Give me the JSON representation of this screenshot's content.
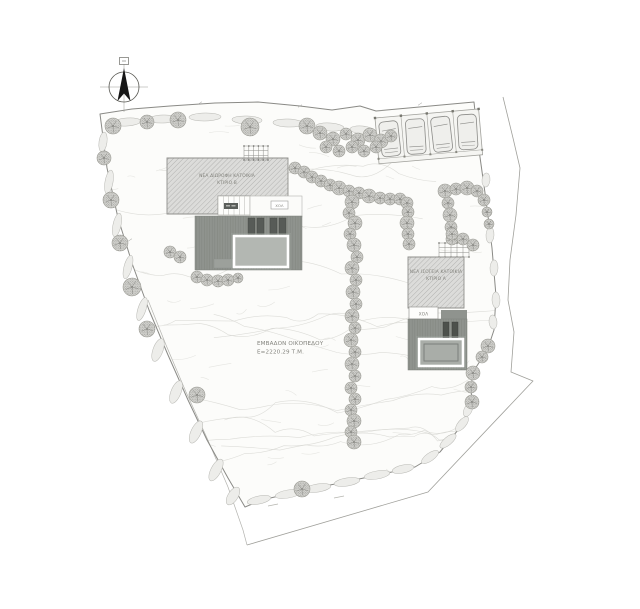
{
  "page": {
    "width": 640,
    "height": 609,
    "background": "#ffffff"
  },
  "labels": {
    "building_b_line1": "ΝΕΑ ΔΙΩΡΟΦΗ ΚΑΤΟΙΚΙΑ",
    "building_b_line2": "ΚΤΙΡΙΟ Β",
    "building_a_line1": "ΝΕΑ ΙΣΟΓΕΙΑ ΚΑΤΟΙΚΙΑ",
    "building_a_line2": "ΚΤΙΡΙΟ Α",
    "hall_b": "ΧΟΛ",
    "hall_a": "ΧΟΛ",
    "area_line1": "ΕΜΒΑΔΟΝ ΟΙΚΟΠΕΔΟΥ",
    "area_line2": "Ε=2220.29 Τ.Μ."
  },
  "colors": {
    "plot_fill": "#fcfcfa",
    "boundary": "#8a8a86",
    "road": "#a0a09b",
    "hatch_bg": "#dcdcda",
    "hatch_line": "#b2b2b0",
    "hatch_edge": "#8f8f8c",
    "terrace": "#8f938e",
    "terrace_edge": "#7c807b",
    "pool_b": "#b3b7b2",
    "pool_a": "#a9ada8",
    "pool_edge": "#7c807b",
    "lounger": "#575b57",
    "door": "#4d514c",
    "tree_fill": "#d2d2ce",
    "tree_dot": "#8e8e8a",
    "tree_edge": "#96968f",
    "shrub": "#b7b7b2",
    "shrub_fill": "#ededea",
    "texture": "#e5e5e1",
    "texture2": "#d7d7d2",
    "car": "#efefec",
    "car_edge": "#8b8b88",
    "label": "#84847e",
    "north": "#161616"
  },
  "drawing": {
    "boundary": [
      [
        100,
        114
      ],
      [
        132,
        109
      ],
      [
        170,
        106
      ],
      [
        215,
        103
      ],
      [
        258,
        102
      ],
      [
        300,
        106
      ],
      [
        332,
        110
      ],
      [
        360,
        106
      ],
      [
        376,
        111
      ],
      [
        474,
        102
      ],
      [
        479,
        150
      ],
      [
        486,
        200
      ],
      [
        492,
        248
      ],
      [
        496,
        296
      ],
      [
        494,
        330
      ],
      [
        489,
        345
      ],
      [
        482,
        358
      ],
      [
        473,
        372
      ],
      [
        471,
        388
      ],
      [
        472,
        404
      ],
      [
        458,
        430
      ],
      [
        440,
        452
      ],
      [
        415,
        467
      ],
      [
        378,
        475
      ],
      [
        340,
        483
      ],
      [
        300,
        491
      ],
      [
        262,
        500
      ],
      [
        245,
        507
      ],
      [
        228,
        478
      ],
      [
        207,
        440
      ],
      [
        188,
        400
      ],
      [
        168,
        355
      ],
      [
        149,
        310
      ],
      [
        133,
        266
      ],
      [
        118,
        218
      ],
      [
        107,
        168
      ]
    ],
    "outer_road_right": [
      [
        503,
        97
      ],
      [
        513,
        138
      ],
      [
        520,
        168
      ],
      [
        516,
        215
      ],
      [
        510,
        260
      ],
      [
        508,
        300
      ],
      [
        514,
        332
      ],
      [
        511,
        372
      ],
      [
        533,
        381
      ],
      [
        428,
        492
      ],
      [
        247,
        545
      ]
    ],
    "outer_road_left": [
      [
        148,
        300
      ],
      [
        166,
        345
      ],
      [
        186,
        392
      ],
      [
        207,
        438
      ],
      [
        228,
        487
      ],
      [
        243,
        530
      ],
      [
        247,
        545
      ]
    ],
    "road_dashes": [
      [
        268,
        506,
        278,
        504
      ],
      [
        334,
        498,
        344,
        496
      ]
    ],
    "ticks": [
      [
        200,
        103
      ],
      [
        300,
        106
      ],
      [
        420,
        104
      ],
      [
        487,
        220
      ],
      [
        495,
        300
      ],
      [
        310,
        489
      ],
      [
        130,
        240
      ]
    ],
    "trees": [
      [
        113,
        126,
        8
      ],
      [
        147,
        122,
        7
      ],
      [
        178,
        120,
        8
      ],
      [
        250,
        127,
        9
      ],
      [
        307,
        126,
        8
      ],
      [
        320,
        133,
        7
      ],
      [
        333,
        139,
        7
      ],
      [
        346,
        134,
        6
      ],
      [
        358,
        140,
        7
      ],
      [
        370,
        135,
        7
      ],
      [
        381,
        141,
        7
      ],
      [
        391,
        136,
        6
      ],
      [
        326,
        147,
        6
      ],
      [
        339,
        151,
        6
      ],
      [
        352,
        147,
        6
      ],
      [
        364,
        151,
        6
      ],
      [
        376,
        147,
        6
      ],
      [
        104,
        158,
        7
      ],
      [
        111,
        200,
        8
      ],
      [
        120,
        243,
        8
      ],
      [
        132,
        287,
        9
      ],
      [
        147,
        329,
        8
      ],
      [
        197,
        395,
        8
      ],
      [
        302,
        489,
        8
      ],
      [
        488,
        346,
        7
      ],
      [
        482,
        357,
        6
      ],
      [
        473,
        373,
        7
      ],
      [
        471,
        387,
        6
      ],
      [
        472,
        402,
        7
      ],
      [
        445,
        191,
        7
      ],
      [
        456,
        189,
        6
      ],
      [
        467,
        188,
        7
      ],
      [
        477,
        191,
        6
      ],
      [
        484,
        200,
        6
      ],
      [
        448,
        203,
        6
      ],
      [
        450,
        215,
        7
      ],
      [
        451,
        227,
        6
      ],
      [
        452,
        239,
        6
      ],
      [
        487,
        212,
        5
      ],
      [
        489,
        224,
        5
      ],
      [
        452,
        234,
        6
      ],
      [
        463,
        239,
        6
      ],
      [
        473,
        245,
        6
      ],
      [
        295,
        168,
        6
      ],
      [
        304,
        172,
        6
      ],
      [
        312,
        177,
        6
      ],
      [
        321,
        181,
        6
      ],
      [
        330,
        185,
        6
      ],
      [
        339,
        188,
        7
      ],
      [
        349,
        191,
        6
      ],
      [
        359,
        193,
        6
      ],
      [
        369,
        196,
        7
      ],
      [
        380,
        198,
        6
      ],
      [
        390,
        199,
        6
      ],
      [
        400,
        199,
        6
      ],
      [
        407,
        203,
        6
      ],
      [
        408,
        212,
        6
      ],
      [
        407,
        223,
        7
      ],
      [
        408,
        234,
        6
      ],
      [
        409,
        244,
        6
      ],
      [
        352,
        202,
        7
      ],
      [
        349,
        213,
        6
      ],
      [
        355,
        223,
        7
      ],
      [
        350,
        234,
        6
      ],
      [
        354,
        245,
        7
      ],
      [
        357,
        257,
        6
      ],
      [
        352,
        268,
        7
      ],
      [
        356,
        280,
        6
      ],
      [
        353,
        292,
        7
      ],
      [
        356,
        304,
        6
      ],
      [
        352,
        316,
        7
      ],
      [
        355,
        328,
        6
      ],
      [
        351,
        340,
        7
      ],
      [
        355,
        352,
        6
      ],
      [
        352,
        364,
        7
      ],
      [
        355,
        376,
        6
      ],
      [
        351,
        388,
        6
      ],
      [
        355,
        399,
        6
      ],
      [
        351,
        410,
        6
      ],
      [
        354,
        421,
        7
      ],
      [
        351,
        432,
        6
      ],
      [
        354,
        442,
        7
      ],
      [
        170,
        252,
        6
      ],
      [
        180,
        257,
        6
      ],
      [
        197,
        277,
        6
      ],
      [
        207,
        280,
        6
      ],
      [
        218,
        281,
        6
      ],
      [
        228,
        280,
        6
      ],
      [
        238,
        278,
        5
      ]
    ],
    "shrubs": [
      [
        127,
        122,
        14,
        4,
        -4
      ],
      [
        163,
        119,
        15,
        4,
        -2
      ],
      [
        205,
        117,
        16,
        4,
        -1
      ],
      [
        247,
        120,
        15,
        4,
        2
      ],
      [
        288,
        123,
        15,
        4,
        2
      ],
      [
        330,
        127,
        14,
        4,
        4
      ],
      [
        362,
        130,
        12,
        4,
        5
      ],
      [
        103,
        142,
        4,
        10,
        8
      ],
      [
        109,
        182,
        4,
        12,
        10
      ],
      [
        117,
        225,
        4,
        12,
        12
      ],
      [
        128,
        267,
        4,
        12,
        15
      ],
      [
        142,
        309,
        4,
        12,
        18
      ],
      [
        158,
        350,
        5,
        12,
        20
      ],
      [
        176,
        392,
        5,
        12,
        22
      ],
      [
        196,
        432,
        5,
        12,
        25
      ],
      [
        216,
        470,
        5,
        12,
        28
      ],
      [
        233,
        496,
        5,
        10,
        32
      ],
      [
        259,
        500,
        12,
        4,
        -12
      ],
      [
        288,
        494,
        13,
        4,
        -10
      ],
      [
        318,
        488,
        13,
        4,
        -9
      ],
      [
        347,
        482,
        13,
        4,
        -9
      ],
      [
        377,
        475,
        13,
        4,
        -10
      ],
      [
        403,
        469,
        11,
        4,
        -12
      ],
      [
        430,
        457,
        10,
        4,
        -35
      ],
      [
        448,
        441,
        10,
        4,
        -40
      ],
      [
        462,
        424,
        9,
        4,
        -50
      ],
      [
        468,
        410,
        7,
        4,
        -65
      ],
      [
        486,
        180,
        4,
        7,
        5
      ],
      [
        490,
        235,
        4,
        8,
        3
      ],
      [
        494,
        268,
        4,
        8,
        2
      ],
      [
        496,
        300,
        4,
        8,
        -2
      ],
      [
        493,
        322,
        4,
        7,
        -5
      ]
    ],
    "building_b": {
      "hatch": "167,158 288,158 288,200 250,200 250,196 218,196 218,214 167,214",
      "pergola": [
        244,
        146,
        24,
        14
      ],
      "wing": [
        218,
        196,
        32,
        19
      ],
      "wing_box": [
        224,
        203,
        14,
        6
      ],
      "courtyard": [
        250,
        196,
        52,
        21
      ],
      "hall_box": [
        271,
        201,
        17,
        8
      ],
      "terrace": [
        195,
        216,
        107,
        54
      ],
      "loungers": [
        [
          248,
          218
        ],
        [
          257,
          218
        ],
        [
          270,
          218
        ],
        [
          279,
          218
        ]
      ],
      "lounger_size": [
        7,
        16
      ],
      "pool": [
        234,
        236,
        54,
        31
      ],
      "step": [
        214,
        259,
        26,
        9
      ]
    },
    "building_a": {
      "pergola": [
        439,
        243,
        30,
        14
      ],
      "hatch": "408,257 464,257 464,308 408,308",
      "hall_box": [
        409,
        307,
        29,
        12
      ],
      "terrace": [
        408,
        319,
        59,
        51
      ],
      "terrace_ext": [
        441,
        310,
        26,
        9
      ],
      "doors": [
        [
          443,
          322,
          6,
          16
        ],
        [
          452,
          322,
          6,
          16
        ]
      ],
      "pool": [
        419,
        339,
        44,
        27
      ],
      "pool_inner": [
        424,
        344,
        34,
        17
      ]
    },
    "parking": {
      "x": 375,
      "y": 118,
      "rot": -5,
      "w": 104,
      "h": 46,
      "stalls": 4,
      "curb_y": 41
    },
    "north": {
      "cx": 124,
      "cy": 87,
      "r": 15
    },
    "label_items": [
      {
        "key": "building_b_line1",
        "name": "building-b-label-line1",
        "x": 227,
        "y": 177,
        "size": 4.4,
        "anchor": "middle"
      },
      {
        "key": "building_b_line2",
        "name": "building-b-label-line2",
        "x": 227,
        "y": 184,
        "size": 4.4,
        "anchor": "middle"
      },
      {
        "key": "building_a_line1",
        "name": "building-a-label-line1",
        "x": 436,
        "y": 273,
        "size": 4.4,
        "anchor": "middle"
      },
      {
        "key": "building_a_line2",
        "name": "building-a-label-line2",
        "x": 436,
        "y": 280,
        "size": 4.4,
        "anchor": "middle"
      },
      {
        "key": "hall_b",
        "name": "hall-label-building-b",
        "x": 279.5,
        "y": 207,
        "size": 3.6,
        "anchor": "middle"
      },
      {
        "key": "hall_a",
        "name": "hall-label-building-a",
        "x": 423.5,
        "y": 315.5,
        "size": 4.2,
        "anchor": "middle"
      },
      {
        "key": "area_line1",
        "name": "plot-area-label",
        "x": 257,
        "y": 345,
        "size": 5.6,
        "anchor": "start"
      },
      {
        "key": "area_line2",
        "name": "plot-area-value",
        "x": 257,
        "y": 353.5,
        "size": 5.6,
        "anchor": "start"
      }
    ]
  }
}
